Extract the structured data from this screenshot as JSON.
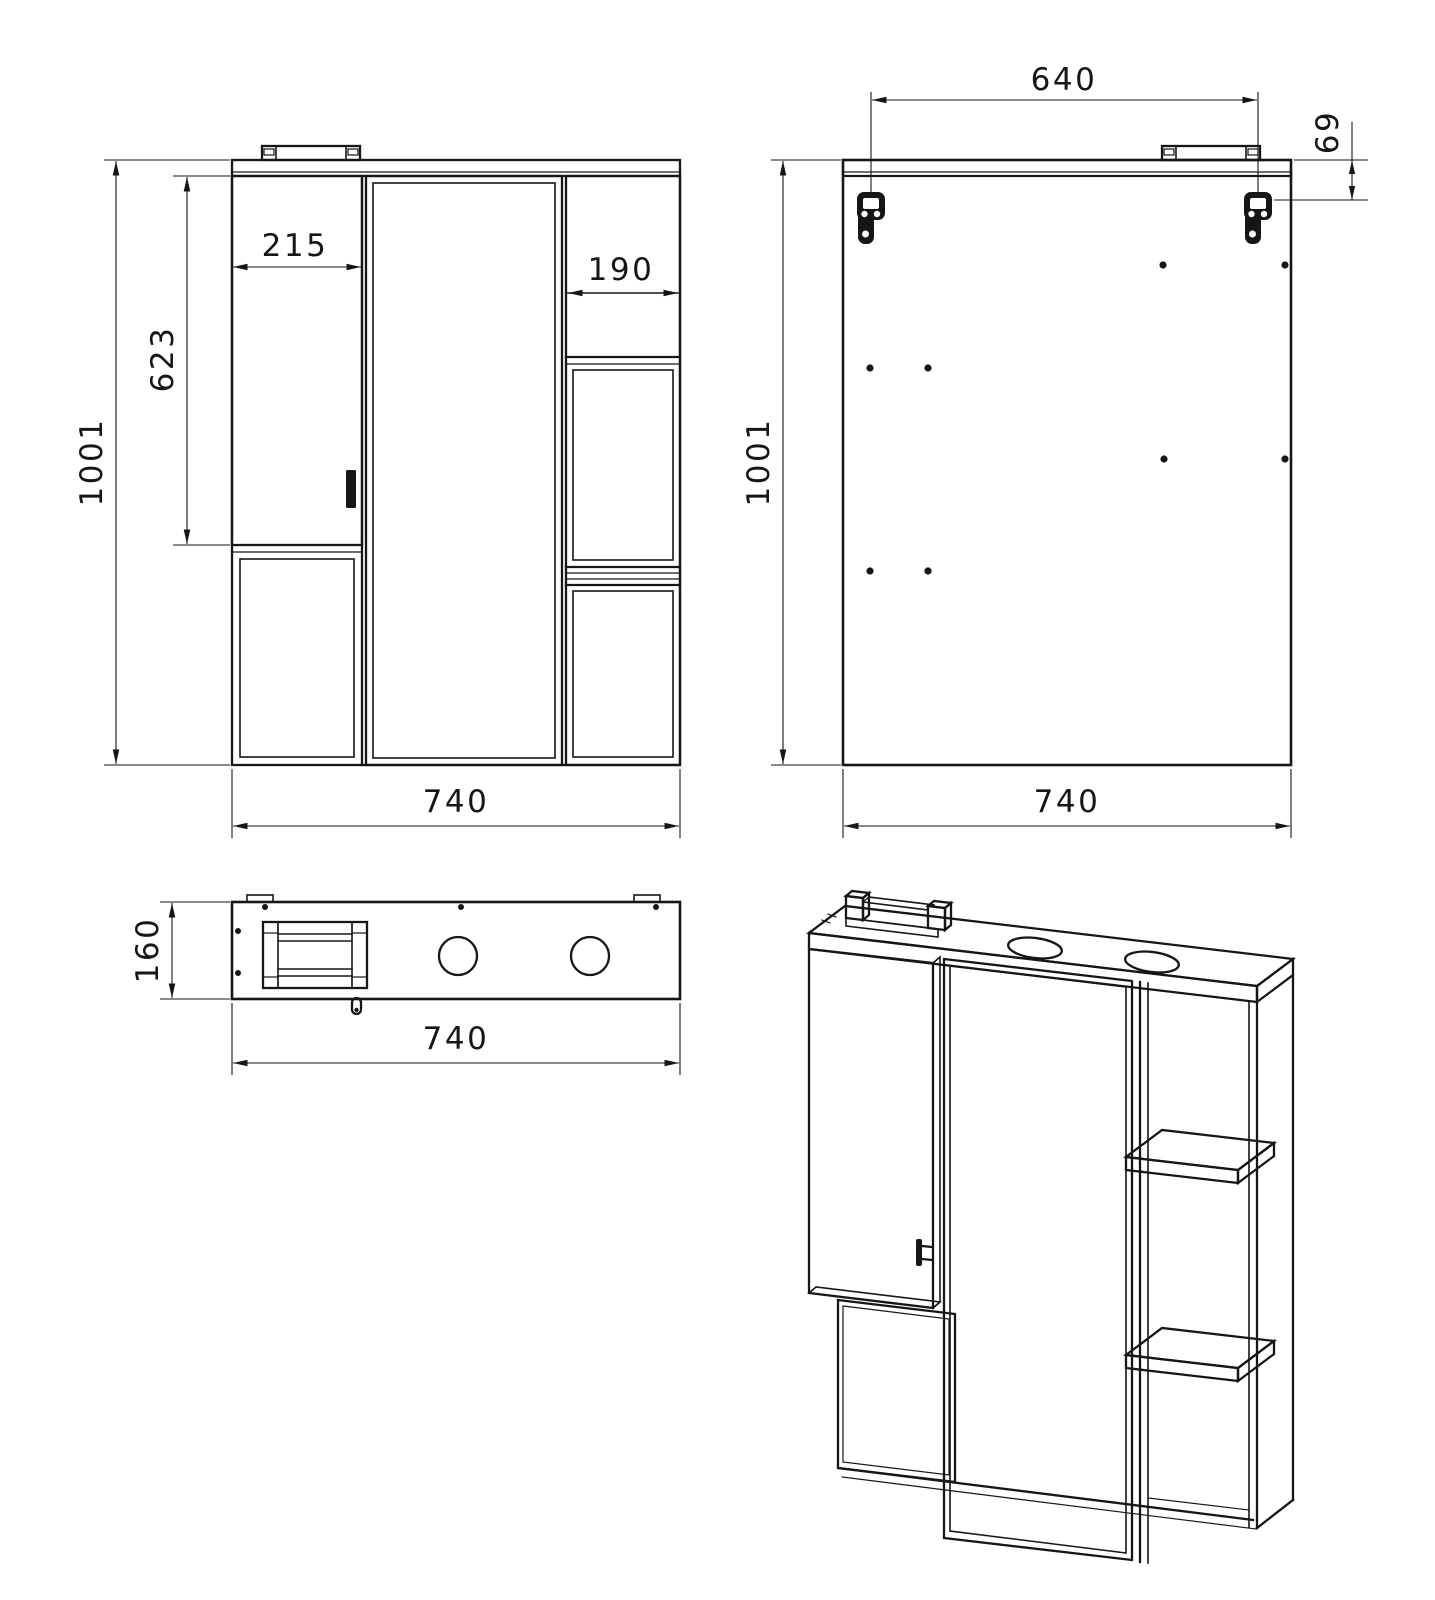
{
  "colors": {
    "background": "#ffffff",
    "line": "#161616"
  },
  "views": {
    "front": {
      "dims": {
        "height": "1001",
        "door_height": "623",
        "door_width": "215",
        "shelf_width": "190",
        "width": "740"
      }
    },
    "back": {
      "dims": {
        "hanger_spacing": "640",
        "hanger_offset": "69",
        "height": "1001",
        "width": "740"
      }
    },
    "top": {
      "dims": {
        "depth": "160",
        "width": "740"
      }
    }
  }
}
